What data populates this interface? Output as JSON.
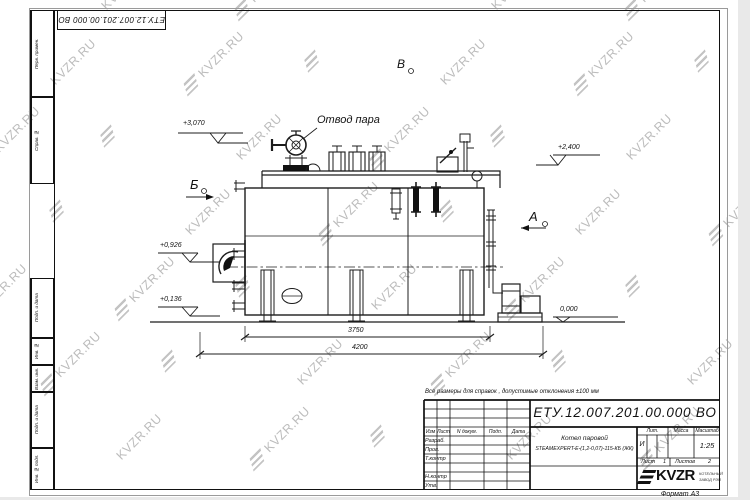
{
  "watermark": {
    "text": "KVZR.RU"
  },
  "sheet": {
    "corner_designation": "ЕТУ.12.007.201.00.000  ВО",
    "format_note": "Формат А3"
  },
  "margin_labels": {
    "top": [
      "Перв. примен.",
      "Справ. №"
    ],
    "bottom": [
      "Подп. и дата",
      "Инв. № дубл.",
      "Взам. инв. №",
      "Подп. и дата",
      "Инв. № подл."
    ]
  },
  "drawing": {
    "callouts": {
      "steam_outlet": "Отвод пара"
    },
    "views": [
      "Б",
      "В",
      "А"
    ],
    "elevations": [
      "+3,070",
      "+2,400",
      "+0,926",
      "+0,136",
      "0,000"
    ],
    "dimensions": [
      "3750",
      "4200"
    ]
  },
  "note": "Все размеры для справок , допустимые отклонения  ±100 мм",
  "title_block": {
    "designation": "ЕТУ.12.007.201.00.000  ВО",
    "product_name_line1": "Котел паровой",
    "product_name_line2": "STEAMEXPERT-E-(1,2-0,07)-115-КБ (ЖК)",
    "revision_header": {
      "izm": "Изм",
      "list": "Лист",
      "doc": "N докум.",
      "sign": "Подп.",
      "date": "Дата"
    },
    "signature_rows": [
      "Разраб.",
      "Пров.",
      "Т.контр",
      "Н.контр",
      "Утв."
    ],
    "lit_label": "Лит.",
    "mass_label": "Масса",
    "scale_label": "Масштаб",
    "lit_value": "И",
    "scale_value": "1:25",
    "sheet_label": "Лист",
    "sheet_number": "1",
    "sheets_label": "Листов",
    "sheets_total": "2",
    "logo": {
      "text": "KVZR",
      "subtext_line1": "КОТЕЛЬНЫЙ",
      "subtext_line2": "ЗАВОД РЭП"
    }
  }
}
